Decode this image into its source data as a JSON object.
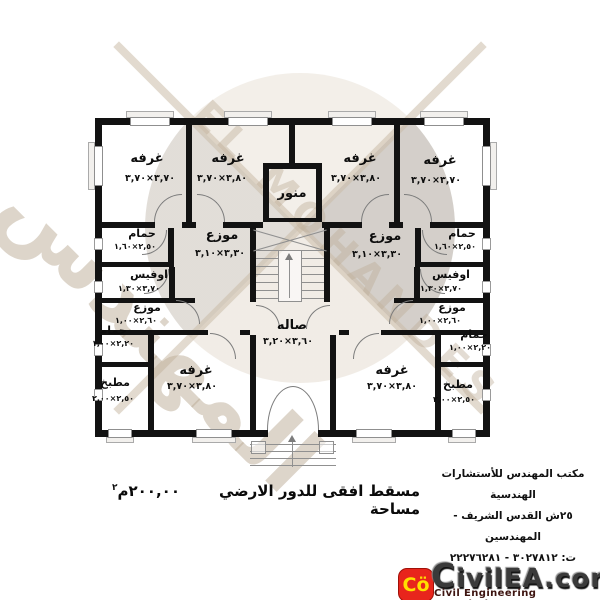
{
  "plan": {
    "rooms": {
      "bed_tl": {
        "name": "غرفه",
        "dims": "٣,٧٠×٣,٧٠"
      },
      "bed_tcl": {
        "name": "غرفه",
        "dims": "٣,٨٠×٣,٧٠"
      },
      "bed_tcr": {
        "name": "غرفه",
        "dims": "٣,٨٠×٣,٧٠"
      },
      "bed_tr": {
        "name": "غرفه",
        "dims": "٣,٧٠×٣,٧٠"
      },
      "manwar": {
        "name": "منور"
      },
      "bath_up_l": {
        "name": "حمام",
        "dims": "٢,٥٠×١,٦٠"
      },
      "bath_up_r": {
        "name": "حمام",
        "dims": "٢,٥٠×١,٦٠"
      },
      "dist_up_l": {
        "name": "موزع",
        "dims": "٣,٣٠×٣,١٠"
      },
      "dist_up_r": {
        "name": "موزع",
        "dims": "٣,٣٠×٣,١٠"
      },
      "office_l": {
        "name": "اوفيس",
        "dims": "٣,٧٠×١,٣٠"
      },
      "office_r": {
        "name": "اوفيس",
        "dims": "٣,٧٠×١,٣٠"
      },
      "dist_lo_l": {
        "name": "موزع",
        "dims": "٢,٦٠×١,٠٠"
      },
      "dist_lo_r": {
        "name": "موزع",
        "dims": "٢,٦٠×١,٠٠"
      },
      "bath_lo_l": {
        "name": "حمام",
        "dims": "٢,٢٠×١,٠٠"
      },
      "bath_lo_r": {
        "name": "حمام",
        "dims": "٢,٢٠×١,٠٠"
      },
      "kitchen_l": {
        "name": "مطبخ",
        "dims": "٢,٥٠×٢,٠٠"
      },
      "kitchen_r": {
        "name": "مطبخ",
        "dims": "٢,٥٠×٢,٠٠"
      },
      "salon": {
        "name": "صاله",
        "dims": "٣,٦٠×٣,٢٠"
      },
      "bed_bl": {
        "name": "غرفه",
        "dims": "٣,٨٠×٣,٧٠"
      },
      "bed_br": {
        "name": "غرفه",
        "dims": "٣,٨٠×٣,٧٠"
      }
    }
  },
  "caption": {
    "text": "مسقط افقى للدور الارضي مساحة",
    "area_value": "٢٠٠,٠٠",
    "area_unit": "م",
    "area_sup": "٢"
  },
  "office_info": {
    "line1": "مكتب المهندس للأستشارات",
    "line2": "الهندسية",
    "line3": "٢٥ش القدس الشريف - المهندسين",
    "line4": "ت:  ٣٠٢٧٨١٢ - ٢٢٢٧٦٢٨١"
  },
  "watermark": {
    "text_ar": "المهندس",
    "text_en": "EL MOHANDES"
  },
  "logo": {
    "badge": "Cö",
    "name": "CivilEA.com",
    "subtitle": "Civil Engineering Association",
    "badge_color": "#e8251c",
    "badge_text_color": "#ffdf00"
  }
}
